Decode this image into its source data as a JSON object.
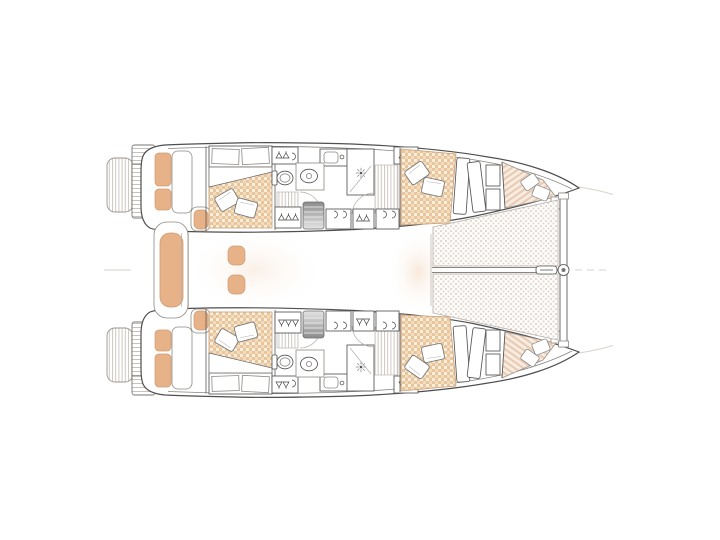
{
  "meta": {
    "title": "Catamaran interior deck plan (top view line drawing)",
    "drawing_type": "technical-floor-plan",
    "text_content": "none – drawing contains no readable text"
  },
  "colors": {
    "background": "#ffffff",
    "line": "#4f4f4f",
    "line_light": "#9a948e",
    "faint": "#d9d2cb",
    "cushion_tan": "#e8b289",
    "cushion_border": "#cf9b72",
    "mattress_base": "#f9efdf",
    "mattress_weave": "#e9c59c",
    "mattress_weave_mid": "#f2dcbd",
    "trampoline_base": "#fefdfc",
    "trampoline_weave": "#e2dad2",
    "forepeak_base": "#f8ebdf",
    "forepeak_stripe": "#e8cab2",
    "steps_dark": "#8c8c8c",
    "steps_light": "#e4e4e4",
    "saloon_wash": "#f6e3d2"
  },
  "elements": {
    "hulls": [
      "port-hull",
      "starboard-hull"
    ],
    "stern": [
      "swim-platform",
      "transom-steps",
      "cockpit-bench",
      "cockpit-lounge",
      "corner-seat"
    ],
    "cabins": [
      "aft-cabin-double-bed",
      "forward-cabin-double-bed",
      "forepeak-berth",
      "pillows"
    ],
    "heads": [
      "shower-stall",
      "shower-drain",
      "toilet",
      "washbasin",
      "sink-counter",
      "door-swing"
    ],
    "storage": [
      "hanging-locker",
      "shelf-locker",
      "companionway-steps",
      "wardrobe"
    ],
    "foredeck": [
      "trampoline-net",
      "forward-crossbeam",
      "bowsprit-line",
      "forestay-fitting",
      "bow-centerline-mark"
    ]
  }
}
